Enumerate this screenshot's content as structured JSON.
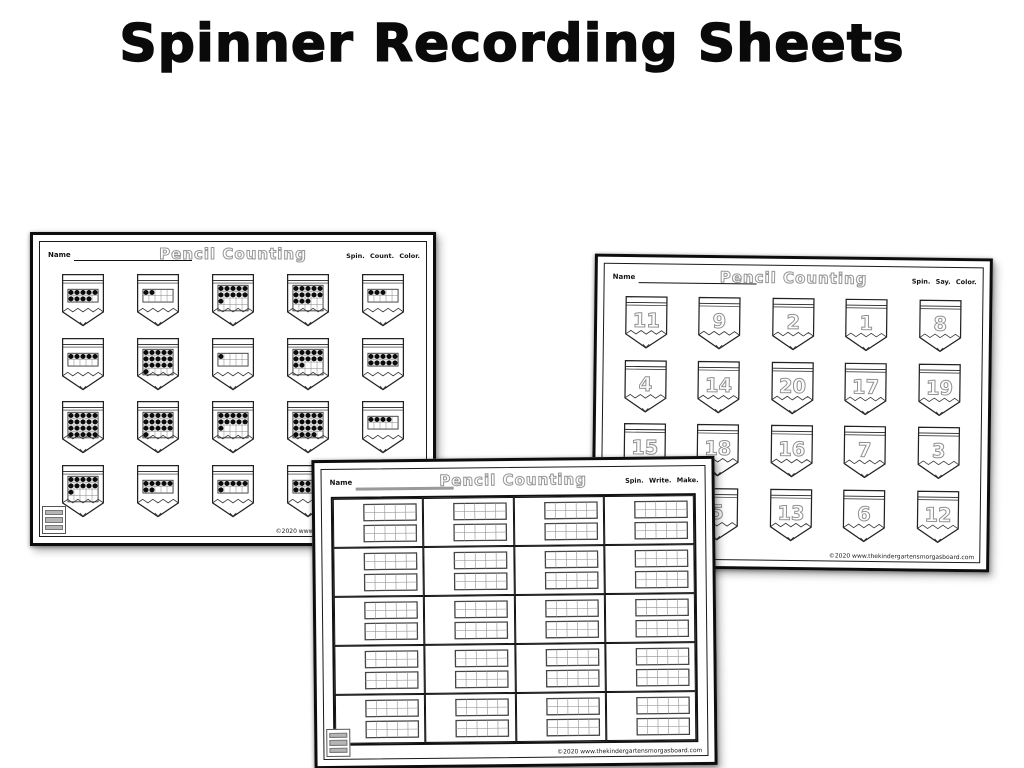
{
  "page_title": "Spinner Recording Sheets",
  "sheets": {
    "count": {
      "title": "Pencil Counting",
      "name_label": "Name",
      "instructions": "Spin. Count. Color.",
      "copyright": "©2020 www.thekindergartensmorgasboard.com",
      "logo": "kindergarten-smorgasboard-logo",
      "pencil_rows": 4,
      "pencil_cols": 5,
      "pencils": [
        {
          "frame": "ten",
          "dots": 9
        },
        {
          "frame": "ten",
          "dots": 2
        },
        {
          "frame": "twenty",
          "dots": 11
        },
        {
          "frame": "twenty",
          "dots": 13
        },
        {
          "frame": "ten",
          "dots": 3
        },
        {
          "frame": "ten",
          "dots": 5
        },
        {
          "frame": "twenty",
          "dots": 16
        },
        {
          "frame": "ten",
          "dots": 1
        },
        {
          "frame": "twenty",
          "dots": 12
        },
        {
          "frame": "ten",
          "dots": 10
        },
        {
          "frame": "twenty",
          "dots": 20
        },
        {
          "frame": "twenty",
          "dots": 16
        },
        {
          "frame": "twenty",
          "dots": 11
        },
        {
          "frame": "twenty",
          "dots": 19
        },
        {
          "frame": "ten",
          "dots": 4
        },
        {
          "frame": "twenty",
          "dots": 11
        },
        {
          "frame": "ten",
          "dots": 7
        },
        {
          "frame": "ten",
          "dots": 6
        },
        {
          "frame": "ten",
          "dots": 8
        },
        {
          "frame": "ten",
          "dots": 0
        }
      ]
    },
    "say": {
      "title": "Pencil Counting",
      "name_label": "Name",
      "instructions": "Spin. Say. Color.",
      "copyright": "©2020 www.thekindergartensmorgasboard.com",
      "pencil_rows": 4,
      "pencil_cols": 5,
      "numbers": [
        "11",
        "9",
        "2",
        "1",
        "8",
        "4",
        "14",
        "20",
        "17",
        "19",
        "15",
        "18",
        "16",
        "7",
        "3",
        "",
        "5",
        "13",
        "6",
        "12"
      ]
    },
    "write": {
      "title": "Pencil Counting",
      "name_label": "Name",
      "instructions": "Spin. Write. Make.",
      "copyright": "©2020 www.thekindergartensmorgasboard.com",
      "logo": "kindergarten-smorgasboard-logo",
      "grid": {
        "rows": 5,
        "cols": 4,
        "frames_per_cell": 2,
        "frame_cols": 5,
        "frame_rows": 2
      }
    }
  },
  "colors": {
    "ink": "#0d0d0d",
    "outline_title": "#979797",
    "grid_line": "#777777",
    "dot": "#0b0b0b",
    "paper": "#ffffff"
  }
}
